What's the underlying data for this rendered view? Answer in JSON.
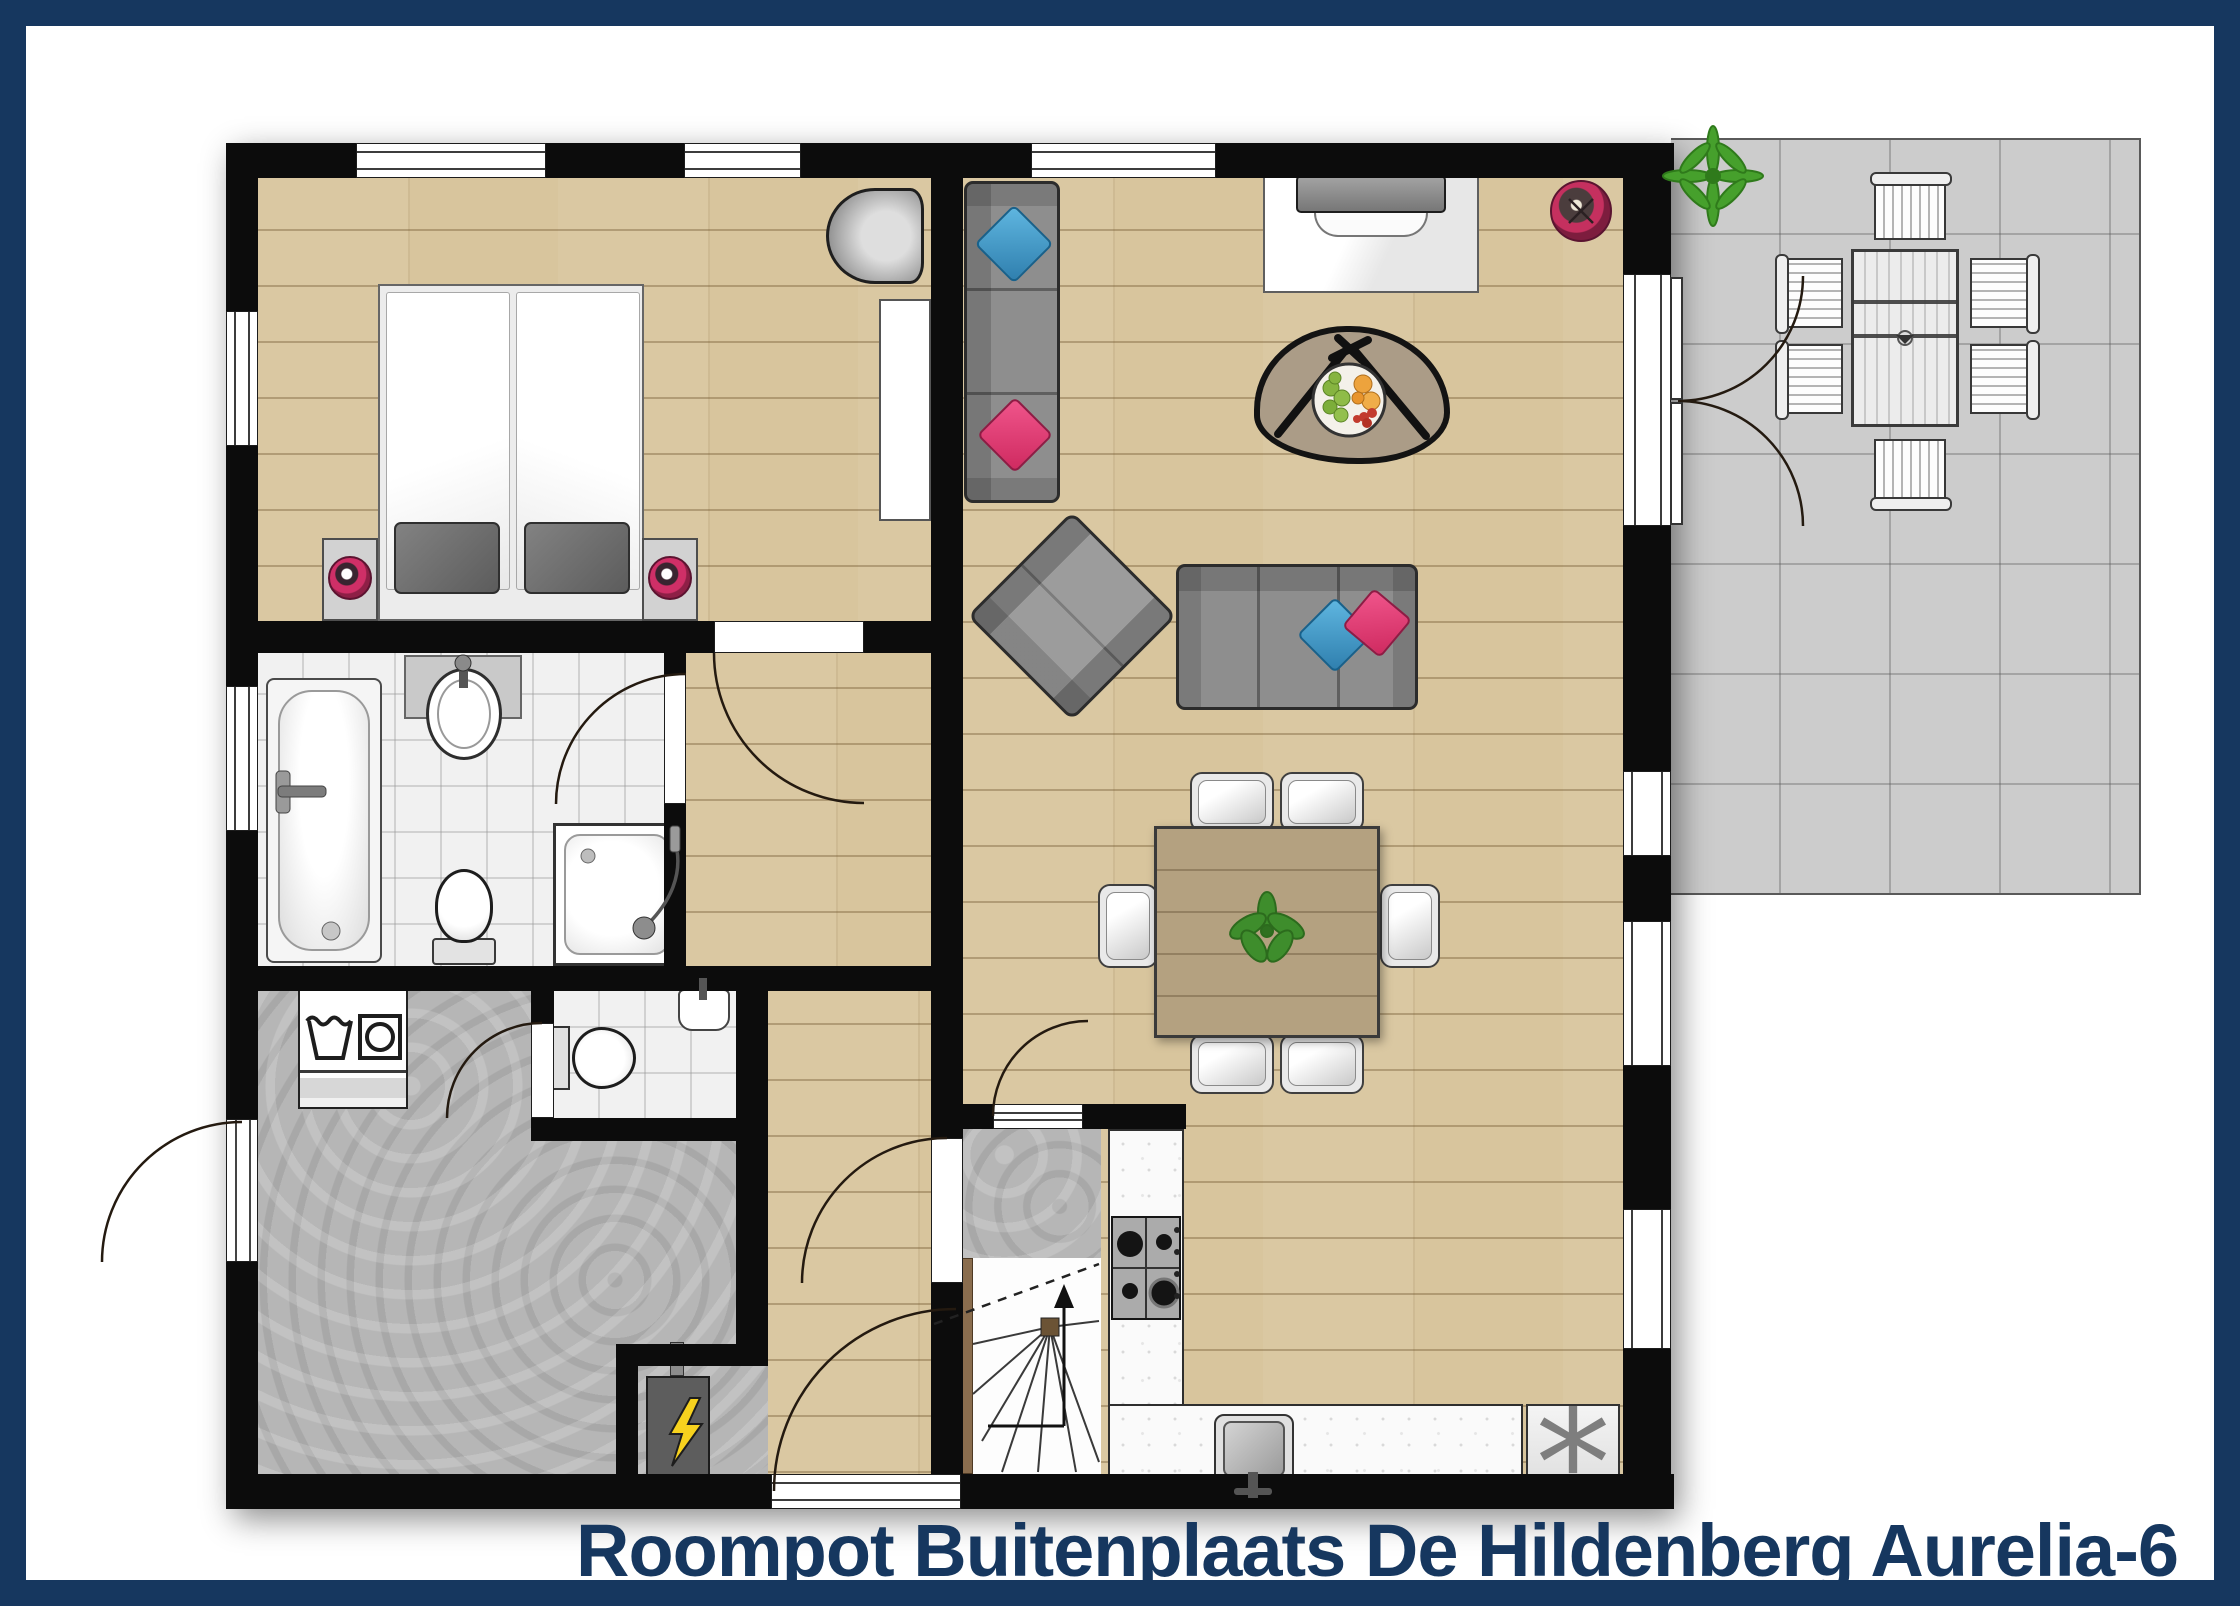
{
  "title": "Roompot Buitenplaats De Hildenberg Aurelia-6",
  "kitchen": {
    "freezer_symbol": "*"
  },
  "colors": {
    "frame_navy": "#16375f",
    "title_navy": "#16375f",
    "wall_black": "#0c0c0c",
    "wood_floor": "#d8c59d",
    "tile_floor": "#f1f1f1",
    "hall_floor_gray": "#b6b6b6",
    "terrace_gray": "#cccccc",
    "sofa_gray": "#8e8e8e",
    "pillow_blue": "#3b99cb",
    "pillow_pink": "#e63a74",
    "lamp_pink": "#cf2f67",
    "dining_table_wood": "#b4a180",
    "plant_green": "#3e8d2c",
    "bolt_yellow": "#f7d21e"
  },
  "icons": [
    "bed-icon",
    "pillow-icon",
    "nightstand-lamp-icon",
    "desk-chair-icon",
    "desk-icon",
    "bathtub-icon",
    "washbasin-icon",
    "toilet-icon",
    "shower-icon",
    "washing-machine-icon",
    "laundry-tub-icon",
    "electrical-panel-icon",
    "stairs-up-arrow-icon",
    "sofa-icon",
    "armchair-icon",
    "coffee-table-icon",
    "fruit-bowl-icon",
    "tv-cabinet-icon",
    "robot-vacuum-icon",
    "dining-table-icon",
    "dining-chair-icon",
    "plant-icon",
    "gas-stove-icon",
    "kitchen-sink-icon",
    "freezer-icon",
    "terrace-table-icon",
    "terrace-chair-icon",
    "door-swing-arc"
  ]
}
